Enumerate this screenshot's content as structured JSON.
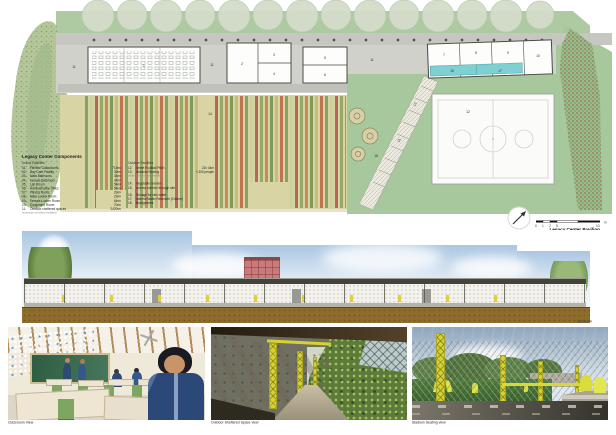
{
  "plan": {
    "title": "Legacy Center Pavilion",
    "subtitle": "Ground Plan",
    "scale_ticks": [
      "0",
      "1",
      "2",
      "5",
      "10"
    ],
    "scale_unit": "m",
    "rooms": [
      "1",
      "2",
      "3",
      "4",
      "5",
      "6",
      "7",
      "8",
      "9",
      "10",
      "11",
      "12",
      "13",
      "14",
      "15",
      "16",
      "17",
      "18"
    ],
    "legend": {
      "title": "Legacy Center Components",
      "indoor_heading": "Indoor Facilities",
      "indoor": [
        [
          "01.",
          "Flexible Classrooms",
          "713m²"
        ],
        [
          "02.",
          "Day Care Facility",
          "39m²"
        ],
        [
          "03.",
          "Male Bathroom",
          "34m²"
        ],
        [
          "04.",
          "Female Bathroom",
          "34m²"
        ],
        [
          "05.",
          "Lab Room",
          "54m²"
        ],
        [
          "06.",
          "Administrative Office",
          "54m²"
        ],
        [
          "07.",
          "Fitness Room",
          "29m²"
        ],
        [
          "08.",
          "Male Locker Room",
          "29m²"
        ],
        [
          "09.",
          "Female Locker Room",
          "64m²"
        ],
        [
          "10.",
          "Equipment Room",
          "70m²"
        ],
        [
          "11.",
          "Outdoor sheltered spaces",
          "2420m²"
        ]
      ],
      "indoor_note": "(extension of indoor facilities)",
      "outdoor_heading": "Outdoor Facilities",
      "outdoor12": [
        "12.",
        "Street Football Pitch",
        "22x 44m"
      ],
      "outdoor13": [
        "13.",
        "Stadium Seating",
        "+-300 people"
      ],
      "outdoor_note": "(extension of indoor facilities)",
      "outdoor14": [
        "14.",
        "Vegetable Garden"
      ],
      "outdoor15": [
        "15.",
        "Access corridor through site"
      ],
      "outdoor16": [
        "16.",
        "Storage for rain water"
      ],
      "outdoor17": [
        "17.",
        "Internal Water Reservoir (Cistern)"
      ],
      "outdoor18": [
        "18.",
        "Biodigesters"
      ]
    }
  },
  "section": {
    "label": "Section A"
  },
  "renders": {
    "captions": [
      "Classroom View",
      "Outdoor Sheltered Space view",
      "Stadium Seating view"
    ]
  },
  "colors": {
    "site_green": "#a7c89c",
    "water_cyan": "#7fd0d2",
    "garden_khaki": "#d8d4a4",
    "truss_yellow": "#d6d233",
    "ground_brown": "#8e6c2c",
    "red_building": "#ca7a7a",
    "chalkboard_green": "#3d6b4f"
  }
}
